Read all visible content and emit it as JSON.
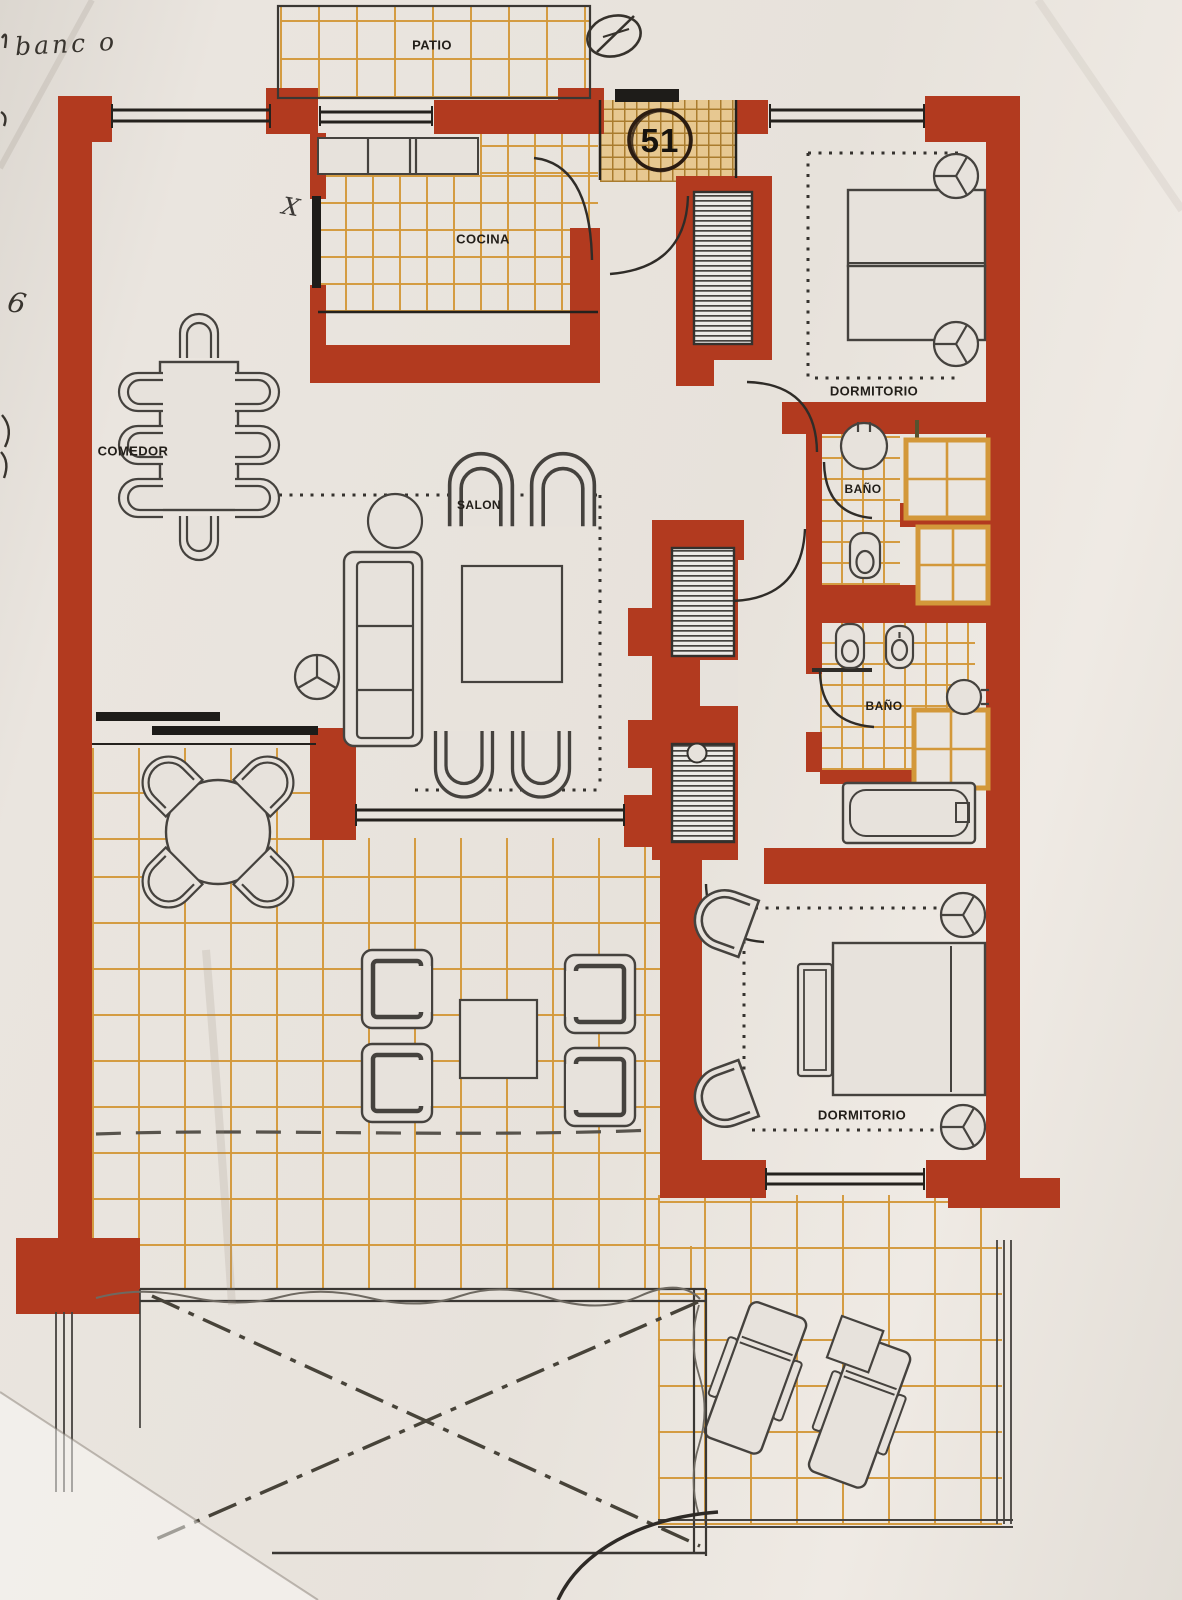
{
  "plan": {
    "unit_number": "51",
    "room_labels": {
      "patio": "PATIO",
      "cocina": "COCINA",
      "comedor": "COMEDOR",
      "salon": "SALON",
      "dormitorio_top": "DORMITORIO",
      "bano_top": "BAÑO",
      "bano_bottom": "BAÑO",
      "dormitorio_bottom": "DORMITORIO"
    },
    "annotations": {
      "handwriting_top_left": "banc o",
      "margin_mark_left": "6",
      "x_mark": "X"
    },
    "colors": {
      "wall": "#b23a1f",
      "tile_line": "#d3983a",
      "entry_tile_bg": "#e7c891",
      "ink": "#2e2a26",
      "paper": "#e7e2dc"
    }
  }
}
